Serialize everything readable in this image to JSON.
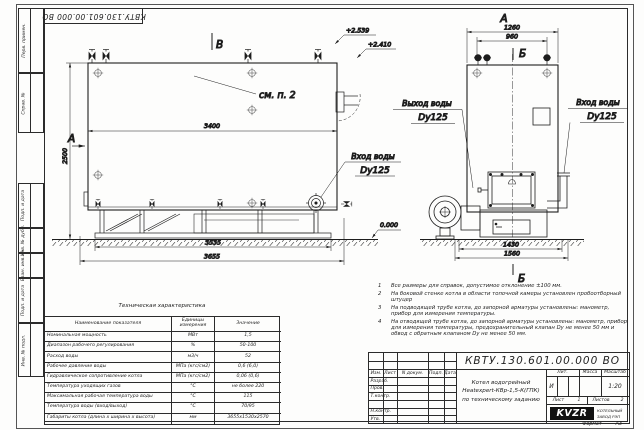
{
  "sheet": {
    "stamp_top": "КВТУ.130.601.00.000 ВО",
    "format_label": "Формат",
    "format_value": "А3"
  },
  "frame_strip": {
    "labels": [
      "Перв. примен.",
      "Справ. №",
      "Подп. и дата",
      "Инв. № дубл.",
      "Взам. инв. №",
      "Подп. и дата",
      "Инв. № подл."
    ]
  },
  "views": {
    "main": {
      "label_top": "В",
      "label_left": "А",
      "see_note": "см. п. 2",
      "dim_width": "3400",
      "dim_height": "2500",
      "dim_base": "3535",
      "dim_overall": "3655",
      "elev_top": "+2.539",
      "elev_mid": "+2.410",
      "elev_ground": "0.000",
      "inlet_line1": "Вход воды",
      "inlet_line2": "Dy125"
    },
    "side": {
      "label_top": "А",
      "section_top": "Б",
      "section_bottom": "Б",
      "dim_width": "1260",
      "dim_inner": "960",
      "dim_base_inner": "1430",
      "dim_base_outer": "1560",
      "outlet_line1": "Выход воды",
      "outlet_line2": "Dy125",
      "inlet_line1": "Вход воды",
      "inlet_line2": "Dy125"
    }
  },
  "tech_table": {
    "title": "Техническая характеристика",
    "col_name": "Наименование показателя",
    "col_units": "Единицы измерения",
    "col_value": "Значение",
    "rows": [
      [
        "Номинальная мощность",
        "МВт",
        "1,5"
      ],
      [
        "Диапазон рабочего регулирования",
        "%",
        "50-100"
      ],
      [
        "Расход воды",
        "м3/ч",
        "52"
      ],
      [
        "Рабочее давление воды",
        "МПа (кгс/см2)",
        "0,6 (6,0)"
      ],
      [
        "Гидравлическое сопротивление котла",
        "МПа (кгс/см2)",
        "0,06 (0,6)"
      ],
      [
        "Температура уходящих газов",
        "°С",
        "не более 220"
      ],
      [
        "Максимальная рабочая температура воды",
        "°С",
        "115"
      ],
      [
        "Температура воды (вход/выход)",
        "°С",
        "70/95"
      ],
      [
        "Габариты котла (длина х ширина х высота)",
        "мм",
        "3655х1530х2570"
      ]
    ]
  },
  "notes": {
    "items": [
      {
        "n": "1",
        "text": "Все размеры для справок, допустимое отклонение ±100 мм."
      },
      {
        "n": "2",
        "text": "На боковой стенке котла в области топочной камеры установлен пробоотборный штуцер"
      },
      {
        "n": "3",
        "text": "На подводящей трубе котла, до запорной арматуры установлены: манометр, прибор для измерения температуры."
      },
      {
        "n": "4",
        "text": "На отводящей трубе котла, до запорной арматуры установлены: манометр, прибор для измерения температуры, предохранительный клапан Dу не менее 50 мм и обвод с обратным клапаном Dу не менее 50 мм."
      }
    ]
  },
  "title_block": {
    "doc_number": "КВТУ.130.601.00.000 ВО",
    "col_izm": "Изм.",
    "col_list": "Лист",
    "col_ndoc": "N докум.",
    "col_podp": "Подп.",
    "col_data": "Дата",
    "row_razrab": "Разраб.",
    "row_prov": "Пров.",
    "row_tkontr": "Т.контр.",
    "row_nkontr": "Н.контр.",
    "row_utv": "Утв.",
    "desc_line1": "Котел водогрейный",
    "desc_line2": "Heatexpert-КВр-1,5-К(ГПК)",
    "desc_line3": "по техническому заданию",
    "lit_label": "Лит.",
    "massa_label": "Масса",
    "scale_label": "Масштаб",
    "lit_value": "И",
    "scale_value": "1:20",
    "sheet_label": "Лист",
    "sheet_value": "1",
    "sheets_label": "Листов",
    "sheets_value": "2",
    "logo": "KVZR",
    "logo_sub1": "КОТЕЛЬНЫЙ",
    "logo_sub2": "ЗАВОД РЭП"
  }
}
